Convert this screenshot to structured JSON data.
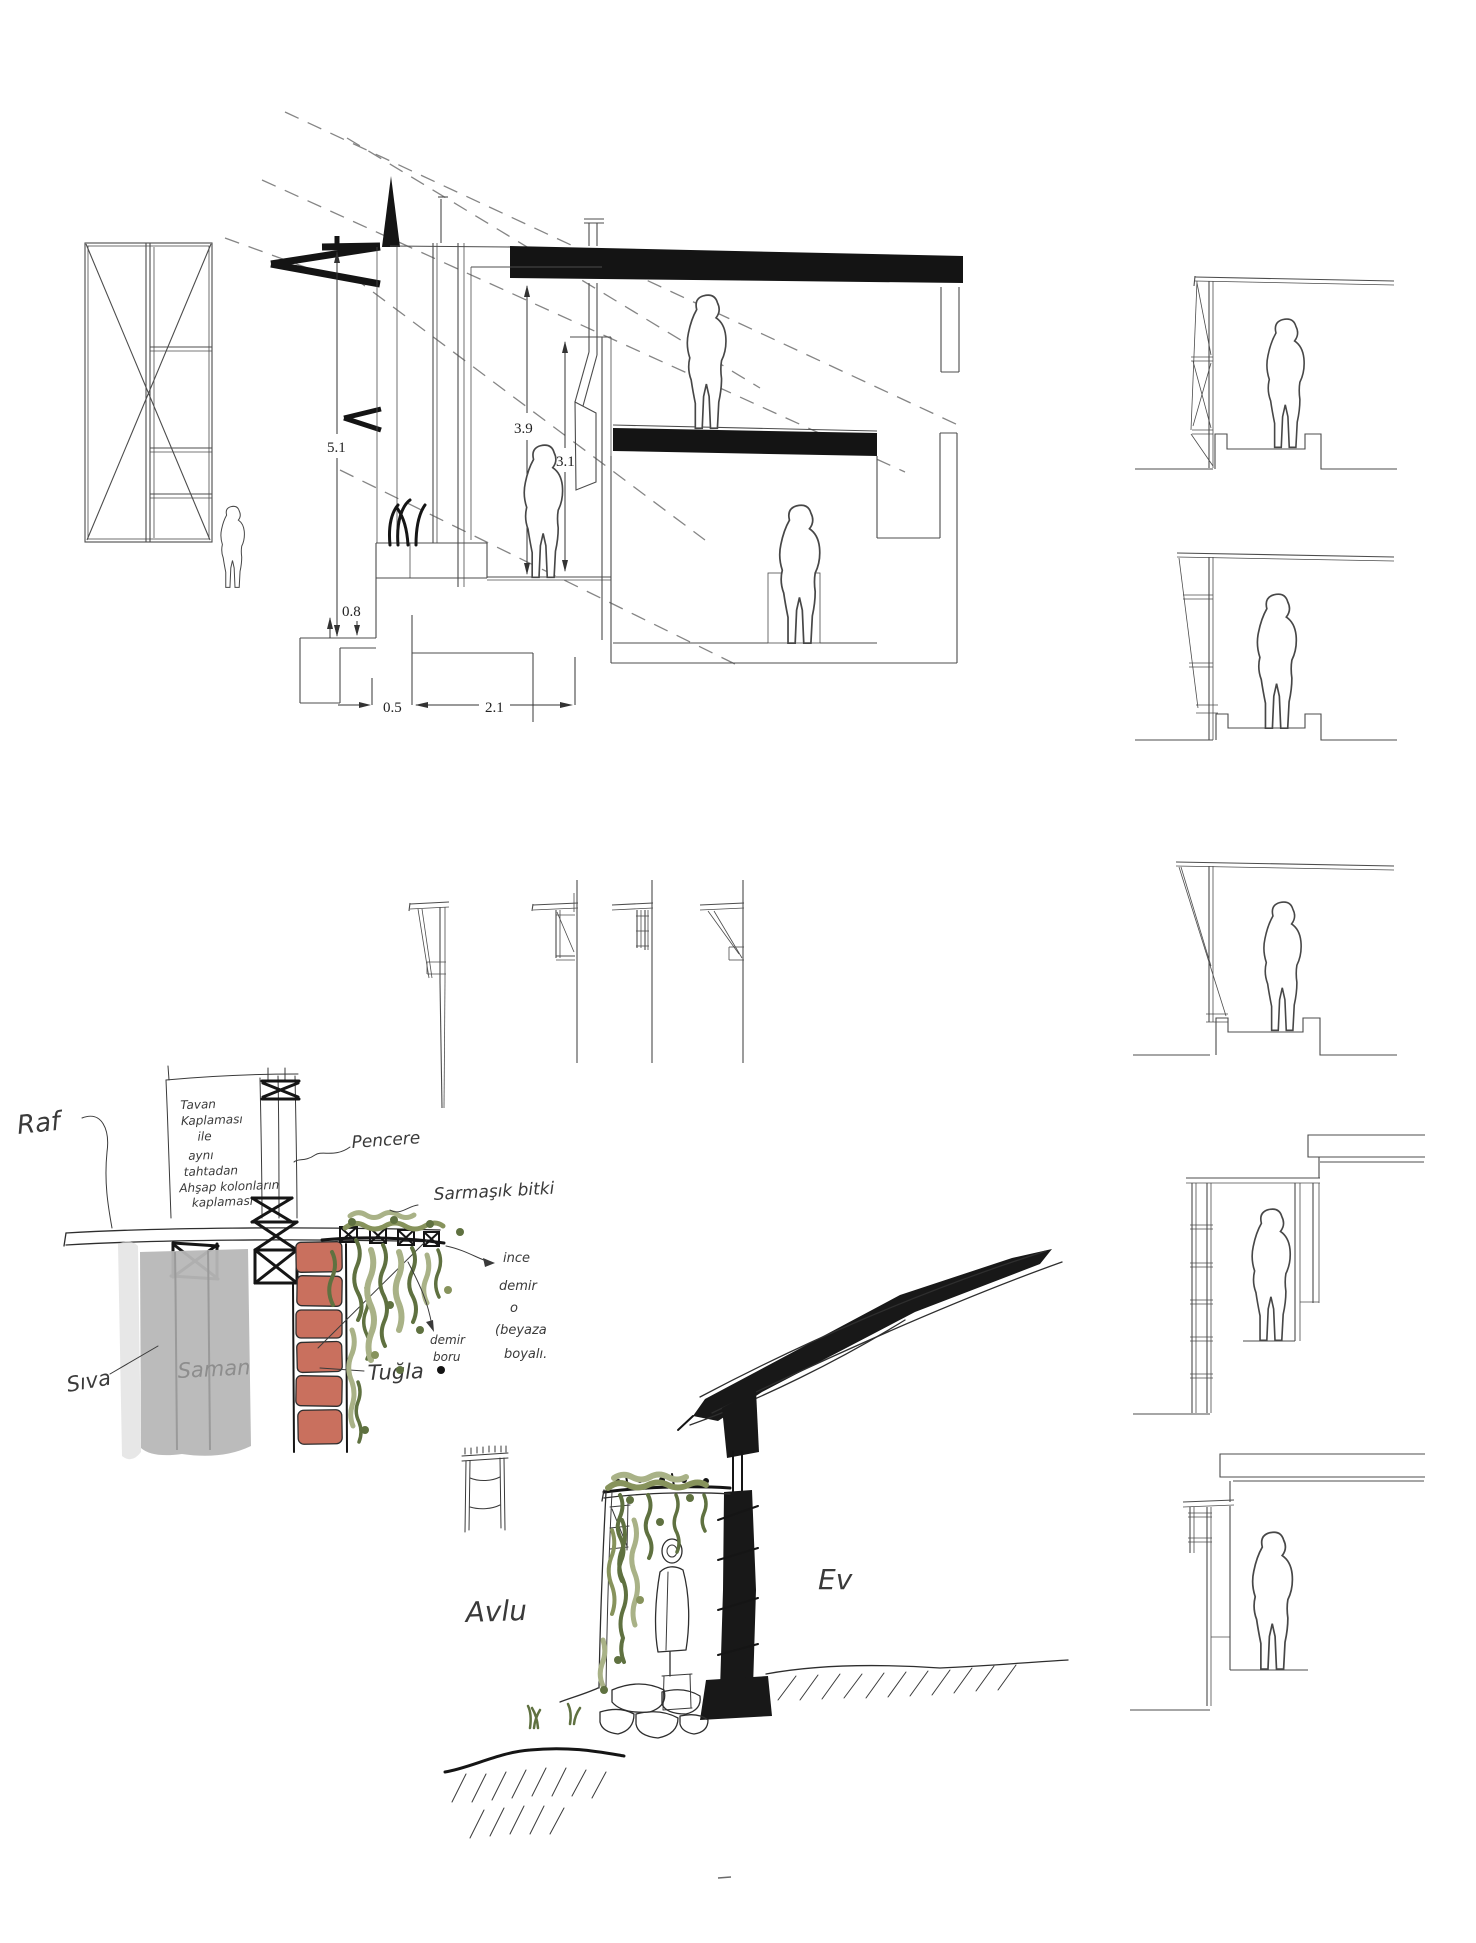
{
  "colors": {
    "ink": "#141414",
    "line": "#4c4c4c",
    "dashline": "#858585",
    "plaster": "#b7b7b7",
    "plaster_light": "#dadada",
    "brick": "#c9705e",
    "green_dark": "#5f7140",
    "green_mid": "#87935c",
    "green_light": "#a9b287"
  },
  "section_dims": {
    "total_height": "5.1",
    "room_height": "3.9",
    "clear_height": "3.1",
    "plinth": "0.8",
    "offset": "0.5",
    "width": "2.1"
  },
  "detail_note": {
    "l1": "Tavan",
    "l2": "Kaplaması",
    "l3": "ile",
    "l4": "aynı",
    "l5": "tahtadan",
    "l6": "Ahşap kolonların",
    "l7": "kaplaması"
  },
  "detail_labels": {
    "shelf": "Raf",
    "window": "Pencere",
    "vine": "Sarmaşık bitki",
    "plaster": "Sıva",
    "straw": "Saman",
    "brick": "Tuğla",
    "iron1": "ince",
    "iron2": "demir",
    "iron3": "o",
    "iron4": "(beyaza",
    "iron5": "boyalı.",
    "pipe1": "demir",
    "pipe2": "boru"
  },
  "courtyard_labels": {
    "courtyard": "Avlu",
    "house": "Ev"
  }
}
